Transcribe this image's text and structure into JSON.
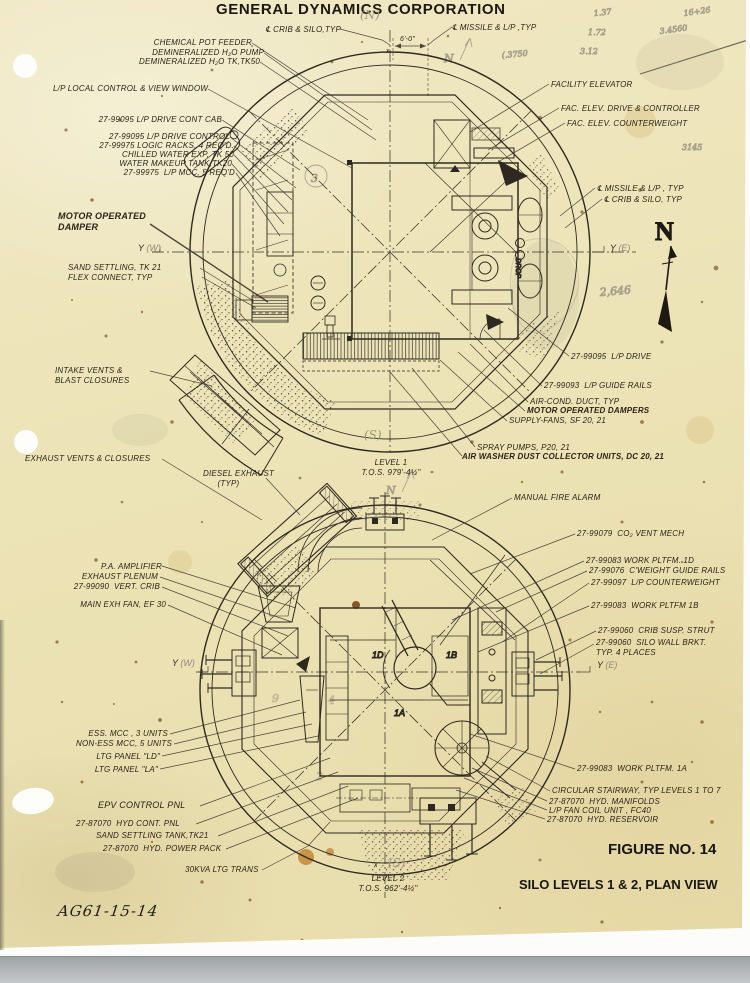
{
  "header": {
    "company": "GENERAL DYNAMICS CORPORATION"
  },
  "axis": {
    "y": "Y",
    "x": "x",
    "n": "N"
  },
  "pencil": {
    "north_top": "(N)",
    "sketch_n1": "N",
    "sketch_n2": "N",
    "calc_a": "16+26",
    "calc_b": "3.4560",
    "calc_c": "1.37",
    "calc_d": "1.72",
    "calc_e": "3.12",
    "note_small": "(.3750",
    "n3145": "3145",
    "n2646": "2,646",
    "circle3": "3",
    "loop9": "9",
    "loop4": "4",
    "loop2": "2",
    "w": "(W)",
    "e": "(E)",
    "s": "(S)"
  },
  "d1": {
    "chem_feeder": "CHEMICAL POT FEEDER",
    "demin_pump": "DEMINERALIZED H₂O PUMP",
    "demin_tank": "DEMINERALIZED H₂O TK,TK50",
    "local_control": "L/P LOCAL CONTROL & VIEW WINDOW",
    "drive_cont_cab": "27-99095 L/P DRIVE CONT CAB",
    "drive_control": "27-99095 L/P DRIVE CONTROL",
    "logic_racks": "27-99975 LOGIC RACKS, 4 REQ'D.",
    "chilled_water": "CHILLED WATER EXP, TK 50",
    "water_makeup": "WATER MAKEUP TANK,TK20",
    "lp_mcc": "27-99975  L/P MCC, 5 REQ'D",
    "motor_damper": "MOTOR OPERATED\nDAMPER",
    "sand_settling": "SAND SETTLING, TK 21\nFLEX CONNECT, TYP",
    "intake_vents": "INTAKE VENTS &\nBLAST CLOSURES",
    "facility_elevator": "FACILITY ELEVATOR",
    "fac_elev_drive": "FAC. ELEV. DRIVE & CONTROLLER",
    "fac_elev_cwt": "FAC. ELEV. COUNTERWEIGHT",
    "cl_missile_r": "℄ MISSILE & L/P , TYP",
    "cl_crib_r": "℄ CRIB & SILO, TYP",
    "cl_crib_top": "℄ CRIB & SILO,TYP",
    "cl_missile_top": "℄ MISSILE & L/P ,TYP",
    "dim": "6'-0\"",
    "lp_drive": "27-99095  L/P DRIVE",
    "guide_rails": "27-99093  L/P GUIDE RAILS",
    "ac_duct": "AIR-COND. DUCT, TYP",
    "mo_dampers": "MOTOR OPERATED DAMPERS",
    "supply_fans": "SUPPLY-FANS, SF 20, 21",
    "spray_pumps": "SPRAY PUMPS, P20, 21",
    "air_washer": "AIR WASHER DUST COLLECTOR UNITS, DC 20, 21",
    "drop": "DROP",
    "level_caption": "LEVEL 1\nT.O.S. 979'-4½\""
  },
  "d2": {
    "exhaust_vents": "EXHAUST VENTS & CLOSURES",
    "diesel_exhaust": "DIESEL EXHAUST\n      (TYP)",
    "fire_alarm": "MANUAL FIRE ALARM",
    "co2_vent": "27-99079  CO₂ VENT MECH",
    "pltfm_1d": "27-99083 WORK PLTFM. 1D",
    "cweight_rails": "27-99076  C'WEIGHT GUIDE RAILS",
    "lp_cwt": "27-99097  L/P COUNTERWEIGHT",
    "pltfm_1b": "27-99083  WORK PLTFM 1B",
    "crib_strut": "27-99060  CRIB SUSP. STRUT",
    "wall_brkt": "27-99060  SILO WALL BRKT.\nTYP. 4 PLACES",
    "pa_amp": "P.A. AMPLIFIER",
    "exh_plenum": "EXHAUST PLENUM",
    "vert_crib": "27-99090  VERT. CRIB",
    "main_exh_fan": "MAIN EXH FAN, EF 30",
    "ess_mcc": "ESS. MCC , 3 UNITS",
    "noness_mcc": "NON-ESS MCC, 5 UNITS",
    "ltg_ld": "LTG PANEL \"LD\"",
    "ltg_la": "LTG PANEL \"LA\"",
    "epv": "EPV CONTROL PNL",
    "hyd_cont": "27-87070  HYD CONT. PNL",
    "sand_tank": "SAND SETTLING TANK,TK21",
    "hyd_pack": "27-87070  HYD. POWER PACK",
    "ltg_trans": "30KVA LTG TRANS",
    "pltfm_1a": "27-99083  WORK PLTFM. 1A",
    "stairway": "CIRCULAR STAIRWAY, TYP LEVELS 1 TO 7",
    "hyd_manifolds": "27-87070  HYD. MANIFOLDS",
    "fan_coil": "L/P FAN COIL UNIT , FC40",
    "hyd_reservoir": "27-87070  HYD. RESERVOIR",
    "level_caption": "LEVEL 2\nT.O.S. 962'-4½\"",
    "p1d": "1D",
    "p1b": "1B",
    "p1a": "1A"
  },
  "footer": {
    "figure_no": "FIGURE NO. 14",
    "title": "SILO LEVELS 1 & 2, PLAN VIEW",
    "doc_no": "AG61-15-14"
  }
}
